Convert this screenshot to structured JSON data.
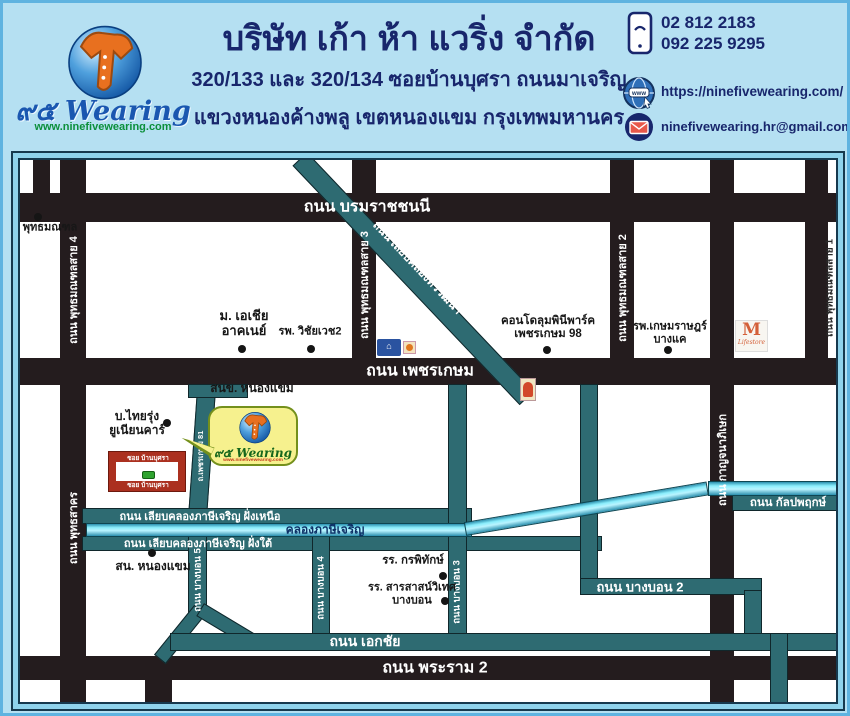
{
  "header": {
    "logo": {
      "brand": "๙๕ Wearing",
      "url": "www.ninefivewearing.com"
    },
    "title": "บริษัท เก้า ห้า แวริ่ง จำกัด",
    "address_line1": "320/133 และ 320/134 ซอยบ้านบุศรา ถนนมาเจริญ",
    "address_line2": "แขวงหนองค้างพลู เขตหนองแขม กรุงเทพมหานคร",
    "phone1": "02 812 2183",
    "phone2": "092 225 9295",
    "website": "https://ninefivewearing.com/",
    "email": "ninefivewearing.hr@gmail.com"
  },
  "map": {
    "roads": {
      "borom": "ถนน บรมราชชนนี",
      "phetkasem": "ถนน เพชรเกษม",
      "rama2": "ถนน พระราม 2",
      "sai4": "ถนน พุทธมณฑลสาย 4",
      "phutthasakhon": "ถนน พุทธสาคร",
      "sai3": "ถนน พุทธมณฑลสาย 3",
      "sai2": "ถนน พุทธมณฑลสาย 2",
      "kanchana": "ถนน กาญจนาภิเษก",
      "sai1": "ถนน พุทธมณฑลสาย 1",
      "liapthawi": "ถนน เลียบคลองทวีวัฒนา",
      "phet81": "ถ.เพชรเกษม 81",
      "liapnuea": "ถนน เลียบคลองภาษีเจริญ ฝั่งเหนือ",
      "liaptai": "ถนน เลียบคลองภาษีเจริญ ฝั่งใต้",
      "bangbon5": "ถนน บางบอน 5",
      "bangbon4": "ถนน บางบอน 4",
      "bangbon3": "ถนน บางบอน 3",
      "bangbon2": "ถนน บางบอน 2",
      "ekachai": "ถนน เอกชัย",
      "kanlapaphruek": "ถนน กัลปพฤกษ์"
    },
    "canal_label": "คลองภาษีเจริญ",
    "places": {
      "phutthamonthon": "พุทธมณฑล",
      "asia1": "ม. เอเชีย",
      "asia2": "อาคเนย์",
      "wichaiwej": "รพ. วิชัยเวช2",
      "condo1": "คอนโดลุมพินีพาร์ค",
      "condo2": "เพชรเกษม 98",
      "kasemrat1": "รพ.เกษมราษฎร์",
      "kasemrat2": "บางแค",
      "thairung1": "บ.ไทยรุ่ง",
      "thairung2": "ยูเนียนคาร์",
      "district_office": "สนข. หนองแขม",
      "police": "สน. หนองแขม",
      "kornpitack": "รร. กรพิทักษ์",
      "sarasas1": "รร. สารสาสน์วิเทศ",
      "sarasas2": "บางบอน"
    },
    "company": {
      "soi_top": "ซอย บ้านบุศรา",
      "soi_bottom": "ซอย บ้านบุศรา",
      "callout_brand": "๙๕ Wearing",
      "callout_url": "www.ninefivewearing.com"
    },
    "landmarks": {
      "m_letter": "M",
      "m_sub": "Lifestore",
      "store_glyph": "⌂"
    }
  },
  "colors": {
    "header_bg": "#b5e0f2",
    "navy_text": "#18266c",
    "brand_blue": "#1a57b0",
    "brand_green": "#0b8f3a",
    "road_black": "#241c1e",
    "road_teal": "#2e6b72",
    "canal_cyan": "#8beefc",
    "marker_red": "#ab301f",
    "marker_green": "#2fa32f",
    "callout_yellow": "#f6f18e"
  }
}
